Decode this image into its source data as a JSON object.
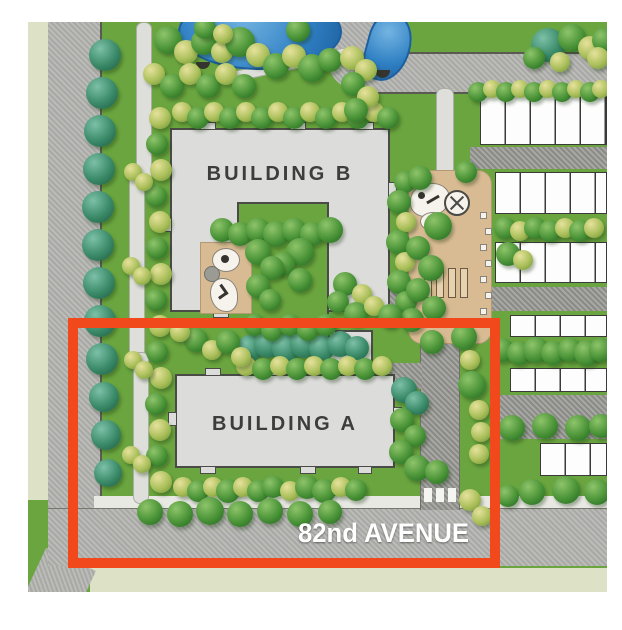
{
  "map": {
    "street_label": "82nd AVENUE",
    "buildings": {
      "a": "BUILDING A",
      "b": "BUILDING B"
    },
    "features": {
      "pond": "pond",
      "playground_b": "playground",
      "plaza": "amenity-plaza",
      "townhouses": "townhouse-rows",
      "highlighted_area": "Building A block outlined in orange"
    },
    "colors": {
      "grass": "#6aa53f",
      "road": "#b5b5b2",
      "lane": "#9d9d99",
      "path": "#dededa",
      "building": "#dcdcdb",
      "building-border": "#4a4a46",
      "pond": "#2f80c3",
      "pond-deep": "#1d5f9e",
      "plaza": "#d9bb93",
      "pale": "#dde2c7",
      "unit": "#fdfdfd",
      "unit-border": "#3a3a38",
      "label": "#3d3d3d",
      "street-text": "#ffffff",
      "highlight": "#f1481c"
    }
  }
}
